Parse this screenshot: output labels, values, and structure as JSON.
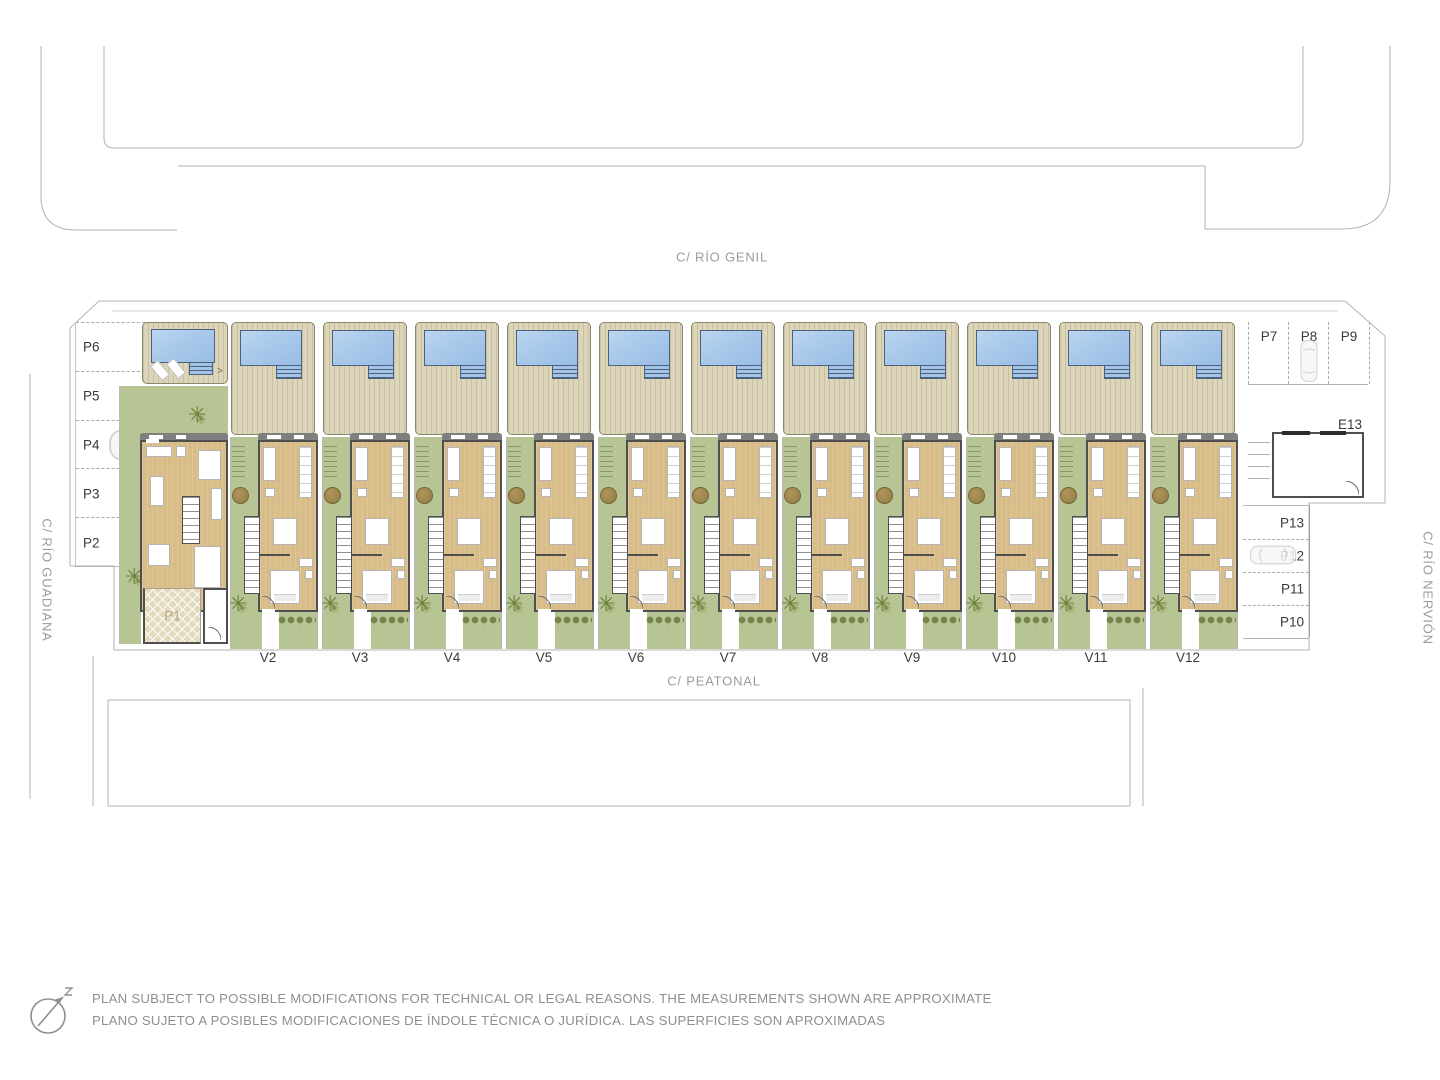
{
  "streets": {
    "top": "C/ RÍO GENIL",
    "left": "C/ RÍO GUADIANA",
    "right": "C/ RÍO NERVIÓN",
    "bottom": "C/  PEATONAL"
  },
  "villas": {
    "end_unit": "V1",
    "row_units": [
      "V2",
      "V3",
      "V4",
      "V5",
      "V6",
      "V7",
      "V8",
      "V9",
      "V10",
      "V11",
      "V12"
    ]
  },
  "parking": {
    "left_column": [
      "P6",
      "P5",
      "P4",
      "P3",
      "P2"
    ],
    "top_right_row": [
      "P7",
      "P8",
      "P9"
    ],
    "bottom_right_column": [
      "P13",
      "P12",
      "P11",
      "P10"
    ],
    "private_space_label": "P1"
  },
  "storage_room_label": "E13",
  "disclaimer": {
    "line_en": "PLAN SUBJECT TO POSSIBLE MODIFICATIONS FOR TECHNICAL OR LEGAL REASONS. THE MEASUREMENTS SHOWN ARE APPROXIMATE",
    "line_es": "PLANO SUJETO A POSIBLES MODIFICACIONES DE ÍNDOLE TÉCNICA O JURÍDICA. LAS SUPERFICIES SON APROXIMADAS"
  },
  "icons": {
    "north_arrow": "north-arrow-icon",
    "car": "car-icon",
    "palm": "palm-tree-icon",
    "tree": "tree-icon",
    "shower_glyph": ">"
  },
  "colors": {
    "pool": "#a6c7e9",
    "deck": "#ddd5ba",
    "garden": "#b7c494",
    "wood_floor": "#d9bd88",
    "wall": "#4f4f4f",
    "outline": "#b3b3b3",
    "street_text": "#9c9c9c",
    "label_text": "#3a3a3a"
  }
}
